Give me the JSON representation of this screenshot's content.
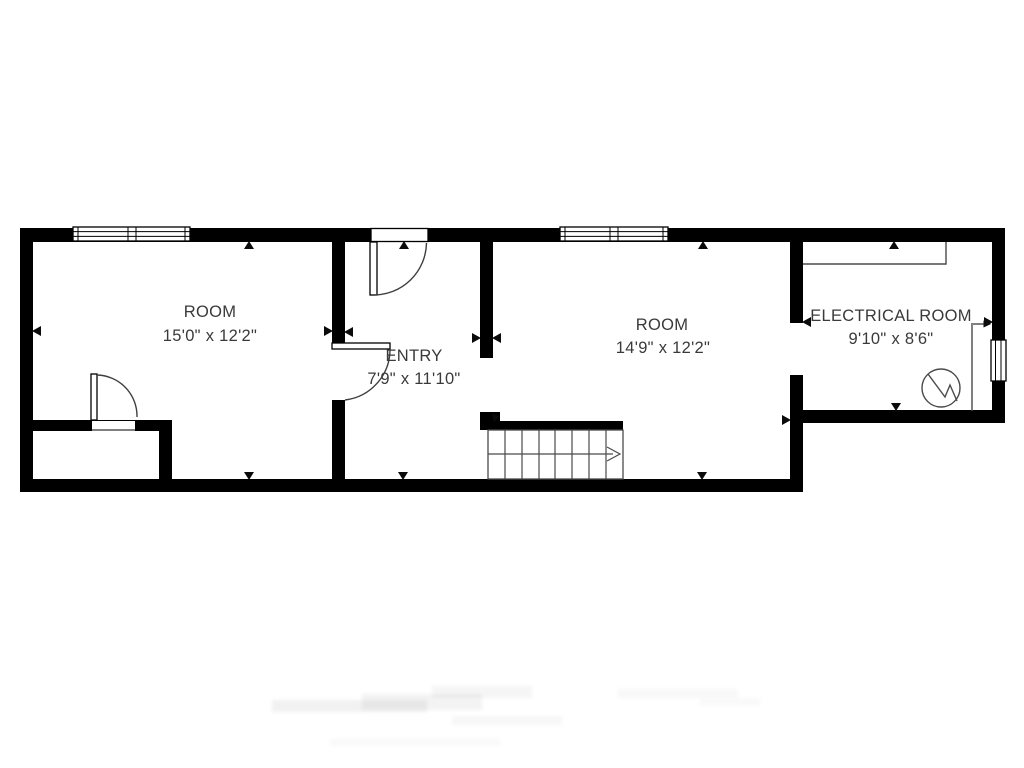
{
  "rooms": [
    {
      "name": "ROOM",
      "size": "15'0\" x 12'2\""
    },
    {
      "name": "ENTRY",
      "size": "7'9\" x 11'10\""
    },
    {
      "name": "ROOM",
      "size": "14'9\" x 12'2\""
    },
    {
      "name": "ELECTRICAL ROOM",
      "size": "9'10\" x 8'6\""
    }
  ],
  "features": {
    "doors_count": 3,
    "windows_count": 3,
    "open_passages_count": 2,
    "stairs": {
      "visible_steps": 8,
      "direction_arrow": "right"
    },
    "symbols": [
      "electrical-panel-circle-zigzag"
    ]
  },
  "colors": {
    "wall": "#000000",
    "background": "#ffffff",
    "thin_line": "#4a4a4a",
    "text": "#3a3a3a"
  }
}
